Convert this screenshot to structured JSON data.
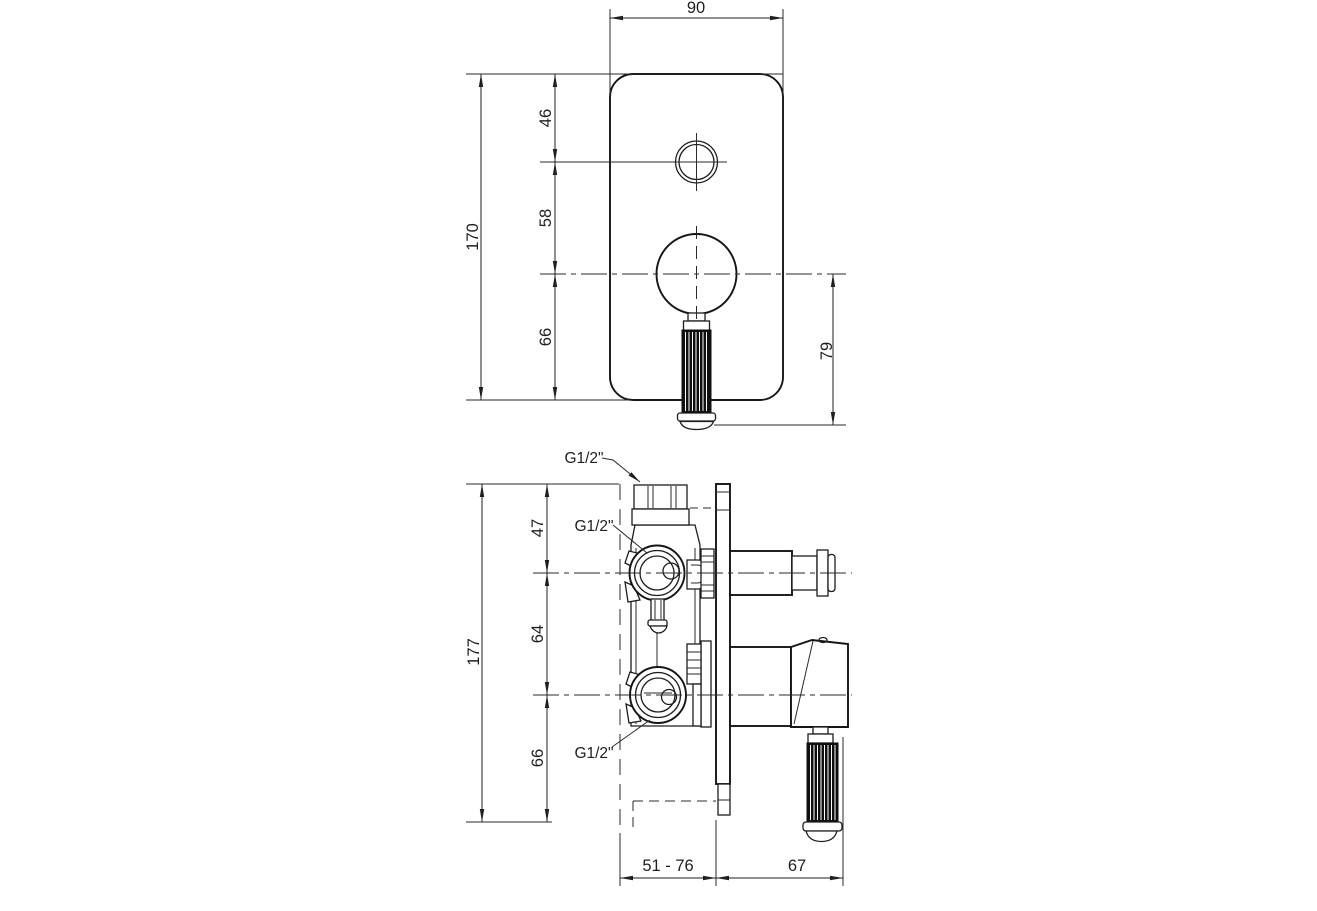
{
  "colors": {
    "background": "#ffffff",
    "line": "#1f1f1f"
  },
  "front_view": {
    "dim_width": "90",
    "dim_height": "170",
    "dim_top_to_knob_center": "46",
    "dim_knob_to_lever_center": "58",
    "dim_lever_center_to_bottom": "66",
    "dim_lever_center_to_handle_tip": "79"
  },
  "side_view": {
    "dim_height": "177",
    "dim_top_to_upper_port": "47",
    "dim_port_spacing": "64",
    "dim_lower_port_to_bottom": "66",
    "dim_recess_depth_range": "51 - 76",
    "dim_protrusion": "67",
    "thread_label_top": "G1/2\"",
    "thread_label_middle": "G1/2\"",
    "thread_label_bottom": "G1/2\""
  }
}
